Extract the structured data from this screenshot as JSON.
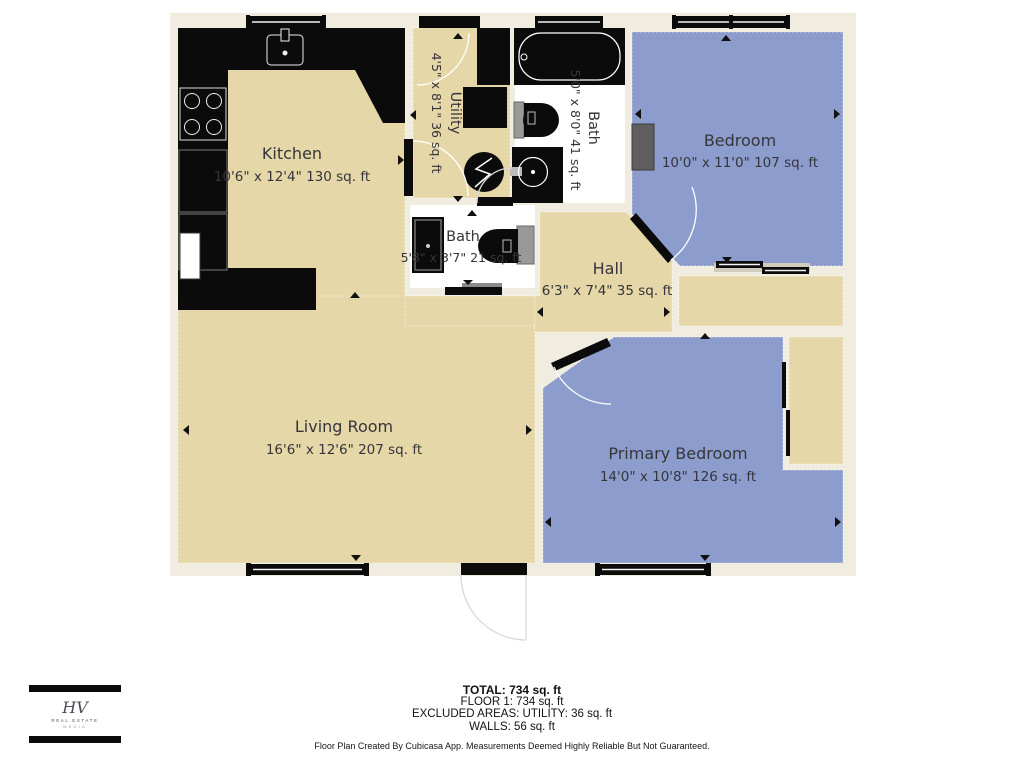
{
  "rooms": {
    "kitchen": {
      "name": "Kitchen",
      "dims": "10'6\" x 12'4\" 130 sq. ft"
    },
    "utility": {
      "name": "Utility",
      "dims": "4'5\" x 8'1\" 36 sq. ft"
    },
    "bath_top": {
      "name": "Bath",
      "dims": "5'0\" x 8'0\" 41 sq. ft"
    },
    "bedroom": {
      "name": "Bedroom",
      "dims": "10'0\" x 11'0\" 107 sq. ft"
    },
    "bath_mid": {
      "name": "Bath",
      "dims": "5'8\" x 3'7\" 21 sq. ft"
    },
    "hall": {
      "name": "Hall",
      "dims": "6'3\" x 7'4\" 35 sq. ft"
    },
    "living": {
      "name": "Living Room",
      "dims": "16'6\" x 12'6\" 207 sq. ft"
    },
    "primary": {
      "name": "Primary Bedroom",
      "dims": "14'0\" x 10'8\" 126 sq. ft"
    }
  },
  "summary": {
    "total": "TOTAL: 734 sq. ft",
    "floor1": "FLOOR 1: 734 sq. ft",
    "excluded": "EXCLUDED AREAS: UTILITY: 36 sq. ft",
    "walls": "WALLS: 56 sq. ft"
  },
  "disclaimer": "Floor Plan Created By Cubicasa App. Measurements Deemed Highly Reliable But Not Guaranteed.",
  "logo": {
    "monogram": "HV",
    "line1": "REAL ESTATE",
    "line2": "MEDIA"
  },
  "colors": {
    "floor_tan": "#E6D7A8",
    "floor_blue": "#8C9DCD",
    "wall_cream": "#F0EDE0",
    "bath_white": "#FFFFFF",
    "fixture_black": "#0B0B0B",
    "fixture_gray": "#999999"
  }
}
